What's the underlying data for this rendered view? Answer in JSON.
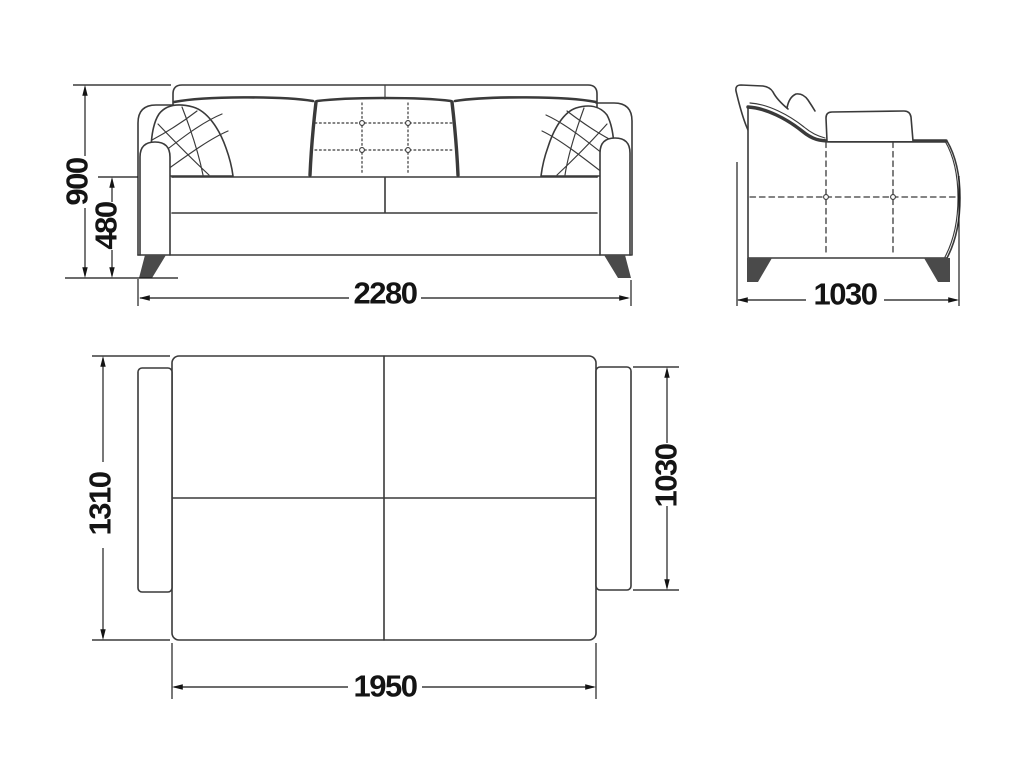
{
  "drawing": {
    "front_view": {
      "overall_height": "900",
      "seat_height": "480",
      "overall_width": "2280"
    },
    "side_view": {
      "overall_depth": "1030"
    },
    "top_view": {
      "unfolded_depth": "1310",
      "side_depth": "1030",
      "bed_width": "1950"
    }
  },
  "colors": {
    "background": "#ffffff",
    "outline": "#3a3a3a",
    "dimension": "#141414",
    "leg": "#4a4a4a"
  }
}
